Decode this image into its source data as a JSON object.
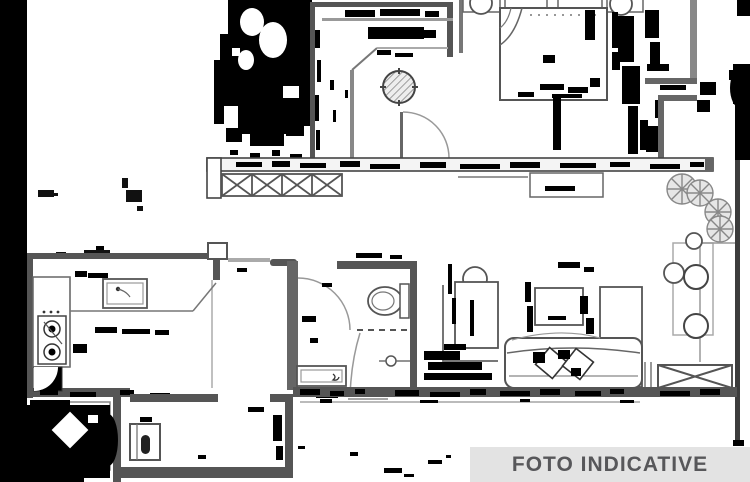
{
  "image": {
    "kind": "apartment floor plan (scanned, heavily thresholded with black ink artifacts)",
    "background_color": "#ffffff",
    "line_color": "#555555",
    "artifact_color": "#000000"
  },
  "banner": {
    "label": "FOTO INDICATIVE",
    "bg": "#e3e3e3",
    "text_color": "#57575a"
  }
}
